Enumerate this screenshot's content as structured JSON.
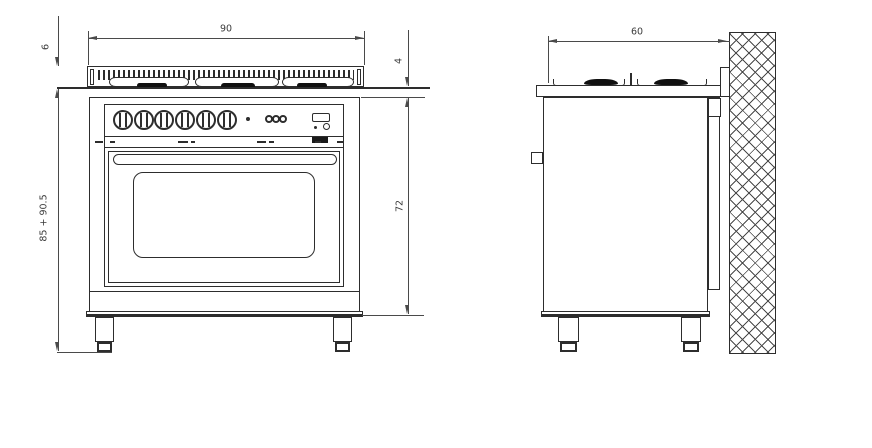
{
  "drawing": {
    "dimensions": {
      "width": "90",
      "hob_height": "6",
      "surface_drop": "4",
      "total_height": "85 + 90.5",
      "body_height": "72",
      "depth": "60"
    },
    "colors": {
      "line": "#2d2d2d",
      "dimension_line": "#4a4a4a",
      "text": "#3c3c3c",
      "burner_cap_fill": "#101010",
      "background": "#ffffff"
    }
  }
}
